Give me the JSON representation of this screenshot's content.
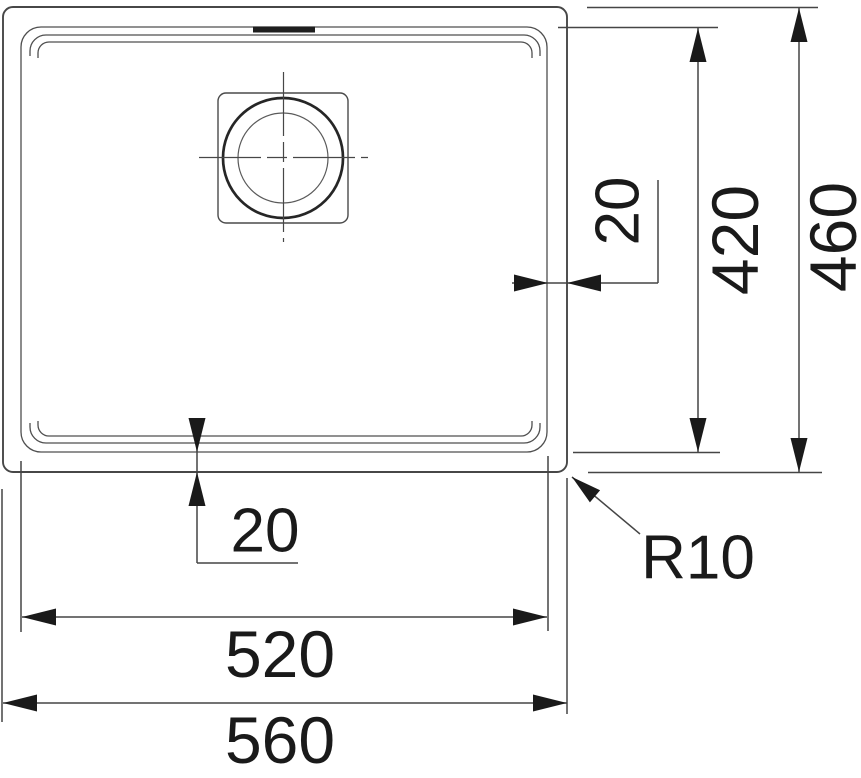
{
  "drawing": {
    "colors": {
      "background": "#ffffff",
      "line": "#4a4a4a",
      "ink": "#1a1a1a"
    },
    "dimensions": {
      "overall_width": "560",
      "basin_width": "520",
      "overall_depth": "460",
      "basin_depth": "420",
      "rim_offset_right": "20",
      "rim_offset_bottom": "20",
      "corner_radius_label": "R10"
    }
  }
}
